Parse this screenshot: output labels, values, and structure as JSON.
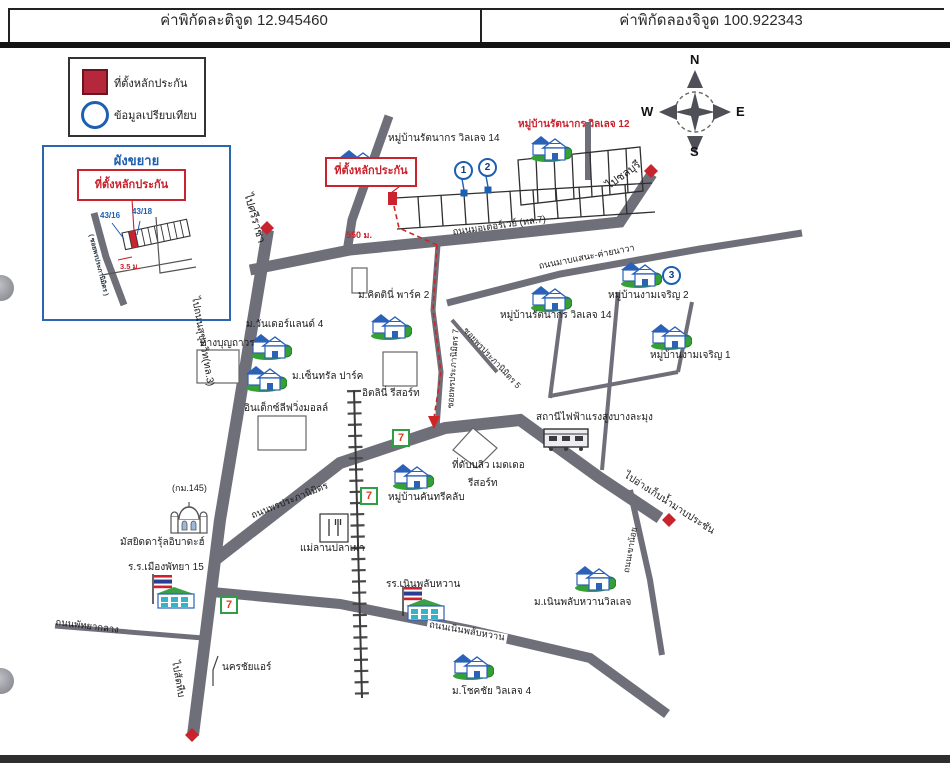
{
  "header": {
    "latitude": "ค่าพิกัดละติจูด 12.945460",
    "longitude": "ค่าพิกัดลองจิจูด 100.922343"
  },
  "legend": {
    "collateral_label": "ที่ตั้งหลักประกัน",
    "comparison_label": "ข้อมูลเปรียบเทียบ"
  },
  "compass": {
    "north": "N",
    "south": "S",
    "east": "E",
    "west": "W"
  },
  "inset": {
    "title": "ผังขยาย",
    "collateral": "ที่ตั้งหลักประกัน",
    "house_no_left": "43/16",
    "house_no_right": "43/18",
    "road": "( ซอยพรประภานิมิตร )",
    "width_label": "3.5 ม."
  },
  "callout": {
    "collateral": "ที่ตั้งหลักประกัน",
    "distance": "550 ม."
  },
  "markers": {
    "one": "1",
    "two": "2",
    "three": "3",
    "seven": "7"
  },
  "roads": {
    "to_sriracha": "ไปศรีราชา",
    "to_chonburi": "ไปชลบุรี",
    "motorway": "ถนนมอเตอร์เวย์ (ทล.7)",
    "mab_sanae": "ถนนมาบแสนะ-ค่ายนาวา",
    "soi7": "ซอยพรประภานิมิตร 7",
    "soi5": "ซอยพรประภานิมิตร 5",
    "phonprapha_nimit": "ถนนพรประภานิมิตร",
    "sukhumvit": "ไปถนนสุขุมวิท(ทล.3)",
    "noen_plub_wan": "ถนนเนินพลับหวาน",
    "khao_noi": "ถนนเขาน้อย",
    "to_reservoir": "ไปอ่างเก็บน้ำมาบประชัน",
    "to_sattahip": "ไปสัตหีบ",
    "pattaya_klang": "ถนนพัทยากลาง",
    "km_marker": "(กม.145)"
  },
  "places": {
    "rattanakorn14_top": "หมู่บ้านรัตนากร วิลเลจ 14",
    "rattanakorn12": "หมู่บ้านรัตนากร วิลเลจ 12",
    "rattanakorn14_mid": "หมู่บ้านรัตนากร วิลเลจ 14",
    "ngamcharoen2": "หมู่บ้านงามเจริญ 2",
    "ngamcharoen1": "หมู่บ้านงามเจริญ 1",
    "wonderland4": "ม.วันเดอร์แลนด์ 4",
    "central_park": "ม.เซ็นทรัล ปาร์ค",
    "kittinee_park2": "ม.คิตตินี่ พาร์ค 2",
    "itlinee_resort": "อิตลินี่ รีสอร์ท",
    "boonthavorn": "ห้างบุญถาวร",
    "index_mall": "อินเด็กซ์ลีฟวิ่งมอลล์",
    "country_club": "หมู่บ้านคันทรีคลับ",
    "w_meadow_line1": "ที่ดับบลิว เมดเดอ",
    "w_meadow_line2": "รีสอร์ท",
    "power_station": "สถานีไฟฟ้าแรงสูงบางละมุง",
    "mosque": "มัสยิดดารุ้ลอิบาดะฮ์",
    "pattaya_school": "ร.ร.เมืองพัทยา 15",
    "fish_restaurant": "แม่ลานปลาเผา",
    "noen_school": "รร.เนินพลับหวาน",
    "noen_village": "ม.เนินพลับหวานวิลเลจ",
    "chokchai4": "ม.โชคชัย วิลเลจ 4",
    "nakhonchai_air": "นครชัยแอร์"
  },
  "colors": {
    "road": "#6f6f7a",
    "collateral_red": "#c9232d",
    "comparison_blue": "#1d5fb0",
    "house_green": "#35a035"
  }
}
